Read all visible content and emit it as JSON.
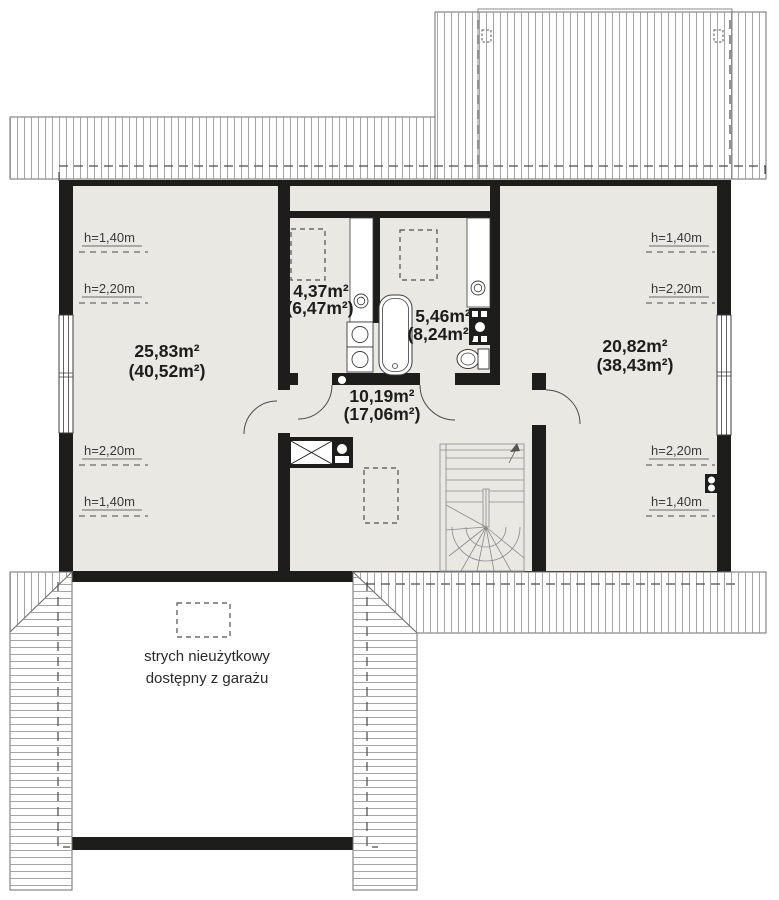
{
  "plan": {
    "rooms": [
      {
        "area": "25,83m²",
        "total": "(40,52m²)"
      },
      {
        "area": "4,37m²",
        "total": "(6,47m²)"
      },
      {
        "area": "5,46m²",
        "total": "(8,24m²)"
      },
      {
        "area": "10,19m²",
        "total": "(17,06m²)"
      },
      {
        "area": "20,82m²",
        "total": "(38,43m²)"
      }
    ],
    "height_labels": [
      "h=1,40m",
      "h=2,20m",
      "h=2,20m",
      "h=1,40m",
      "h=1,40m",
      "h=2,20m",
      "h=2,20m",
      "h=1,40m"
    ],
    "attic_note": {
      "line1": "strych nieużytkowy",
      "line2": "dostępny z garażu"
    },
    "colors": {
      "wall": "#1d1d1b",
      "floor": "#e9e8e3",
      "hatch_line": "#9a9a9a",
      "roof_edge": "#6e6e6e",
      "dashed_guide": "#4a4a4a",
      "fixture_stroke": "#3c3c3c",
      "stair_line": "#8a8a8a",
      "label_text": "#1d1d1b",
      "height_text": "#3a3a3a"
    }
  }
}
